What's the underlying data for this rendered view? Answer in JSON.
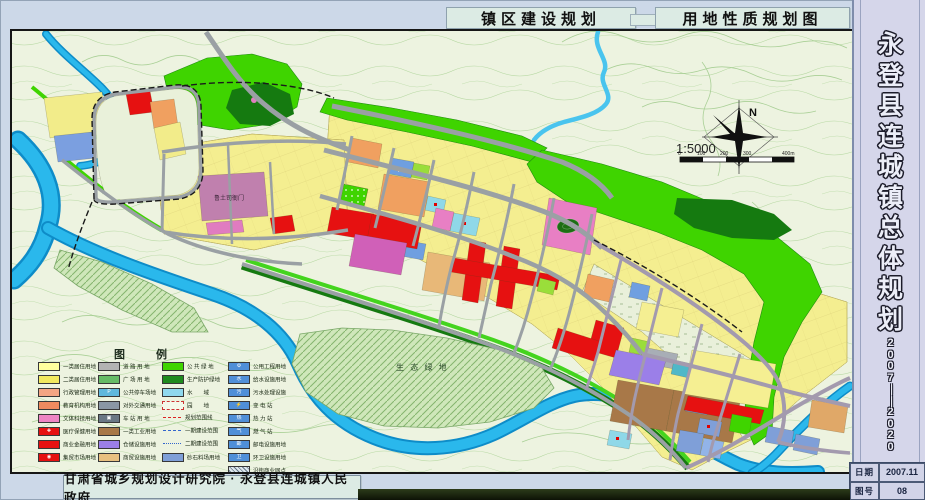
{
  "header": {
    "plan_type": "镇区建设规划",
    "map_title": "用地性质规划图"
  },
  "sidebar": {
    "title": "永登县连城镇总体规划",
    "period": "2007——2020",
    "info": [
      {
        "label": "日期",
        "value": "2007.11"
      },
      {
        "label": "图号",
        "value": "08"
      }
    ]
  },
  "footer": {
    "credit": "甘肃省城乡规划设计研究院 · 永登县连城镇人民政府"
  },
  "map": {
    "north": "N",
    "scale": "1:5000",
    "scale_ticks": [
      "0",
      "100",
      "200",
      "300",
      "400m"
    ],
    "labels": {
      "heritage": "鲁土司衙门",
      "eco": "生 态 绿 地"
    },
    "legend": {
      "title": "图  例",
      "columns": [
        [
          {
            "label": "一类居住用地",
            "color": "#ffff9e",
            "type": "solid"
          },
          {
            "label": "二类居住用地",
            "color": "#f2e95f",
            "type": "solid"
          },
          {
            "label": "行政管理用地",
            "color": "#f4a583",
            "type": "solid"
          },
          {
            "label": "教育机构用地",
            "color": "#ef8a5f",
            "type": "solid"
          },
          {
            "label": "文体科技用地",
            "color": "#ee85c4",
            "type": "solid"
          },
          {
            "label": "医疗保健用地",
            "color": "#e61111",
            "type": "symbol",
            "symbol": "✚"
          },
          {
            "label": "商业金融用地",
            "color": "#e61111",
            "type": "solid"
          },
          {
            "label": "集贸市场用地",
            "color": "#e61111",
            "type": "symbol",
            "symbol": "◉"
          }
        ],
        [
          {
            "label": "道 路 用 地",
            "color": "#b3b3b3",
            "type": "solid"
          },
          {
            "label": "广 场 用 地",
            "color": "#66bb66",
            "type": "solid"
          },
          {
            "label": "公共停车场地",
            "color": "#5fb8dd",
            "type": "symbol",
            "symbol": "P"
          },
          {
            "label": "对外交通用地",
            "color": "#8a97a5",
            "type": "solid"
          },
          {
            "label": "车 站 用 地",
            "color": "#6a7885",
            "type": "symbol",
            "symbol": "▣"
          },
          {
            "label": "一类工业用地",
            "color": "#a87848",
            "type": "solid"
          },
          {
            "label": "仓储设施用地",
            "color": "#9b7fe8",
            "type": "solid"
          },
          {
            "label": "商贸设施用地",
            "color": "#e8c080",
            "type": "solid"
          }
        ],
        [
          {
            "label": "公 共 绿 地",
            "color": "#3fd400",
            "type": "solid"
          },
          {
            "label": "生产防护绿地",
            "color": "#1e8a1e",
            "type": "solid"
          },
          {
            "label": "水　　域",
            "color": "#8fd8ee",
            "type": "solid"
          },
          {
            "label": "园　　地",
            "color": "#f4f9ea",
            "type": "dashed-box"
          },
          {
            "label": "规划范围线",
            "type": "line",
            "line": "red-dash"
          },
          {
            "label": "一期建设范围",
            "type": "line",
            "line": "blue-dash"
          },
          {
            "label": "二期建设范围",
            "type": "line",
            "line": "blue-dashdot"
          },
          {
            "label": "砂石料场用地",
            "color": "#7f9fd8",
            "type": "solid"
          }
        ],
        [
          {
            "label": "公用工程用地",
            "color": "#4f8fd8",
            "type": "symbol",
            "symbol": "⚙"
          },
          {
            "label": "给水设施用地",
            "color": "#4f8fd8",
            "type": "symbol",
            "symbol": "水"
          },
          {
            "label": "污水处理设施",
            "color": "#4f8fd8",
            "type": "symbol",
            "symbol": "污"
          },
          {
            "label": "变 电 站",
            "color": "#4f8fd8",
            "type": "symbol",
            "symbol": "⚡"
          },
          {
            "label": "热 力 站",
            "color": "#4f8fd8",
            "type": "symbol",
            "symbol": "热"
          },
          {
            "label": "燃 气 站",
            "color": "#4f8fd8",
            "type": "symbol",
            "symbol": "气"
          },
          {
            "label": "邮电设施用地",
            "color": "#4f8fd8",
            "type": "symbol",
            "symbol": "邮"
          },
          {
            "label": "环卫设施用地",
            "color": "#4f8fd8",
            "type": "symbol",
            "symbol": "卫"
          },
          {
            "label": "沿街商业网点",
            "type": "hatched"
          }
        ]
      ]
    }
  },
  "colors": {
    "page_bg": "#ccd8e8",
    "panel_bg": "#dcebe4",
    "sidebar_bg": "#d5d6ea",
    "map_bg": "#edf3e0",
    "water": "#2ab8ec",
    "residential_yellow": "#f4ee90",
    "commercial_red": "#e61111",
    "green_space": "#3fd400",
    "road_gray": "#9aa0a4"
  }
}
